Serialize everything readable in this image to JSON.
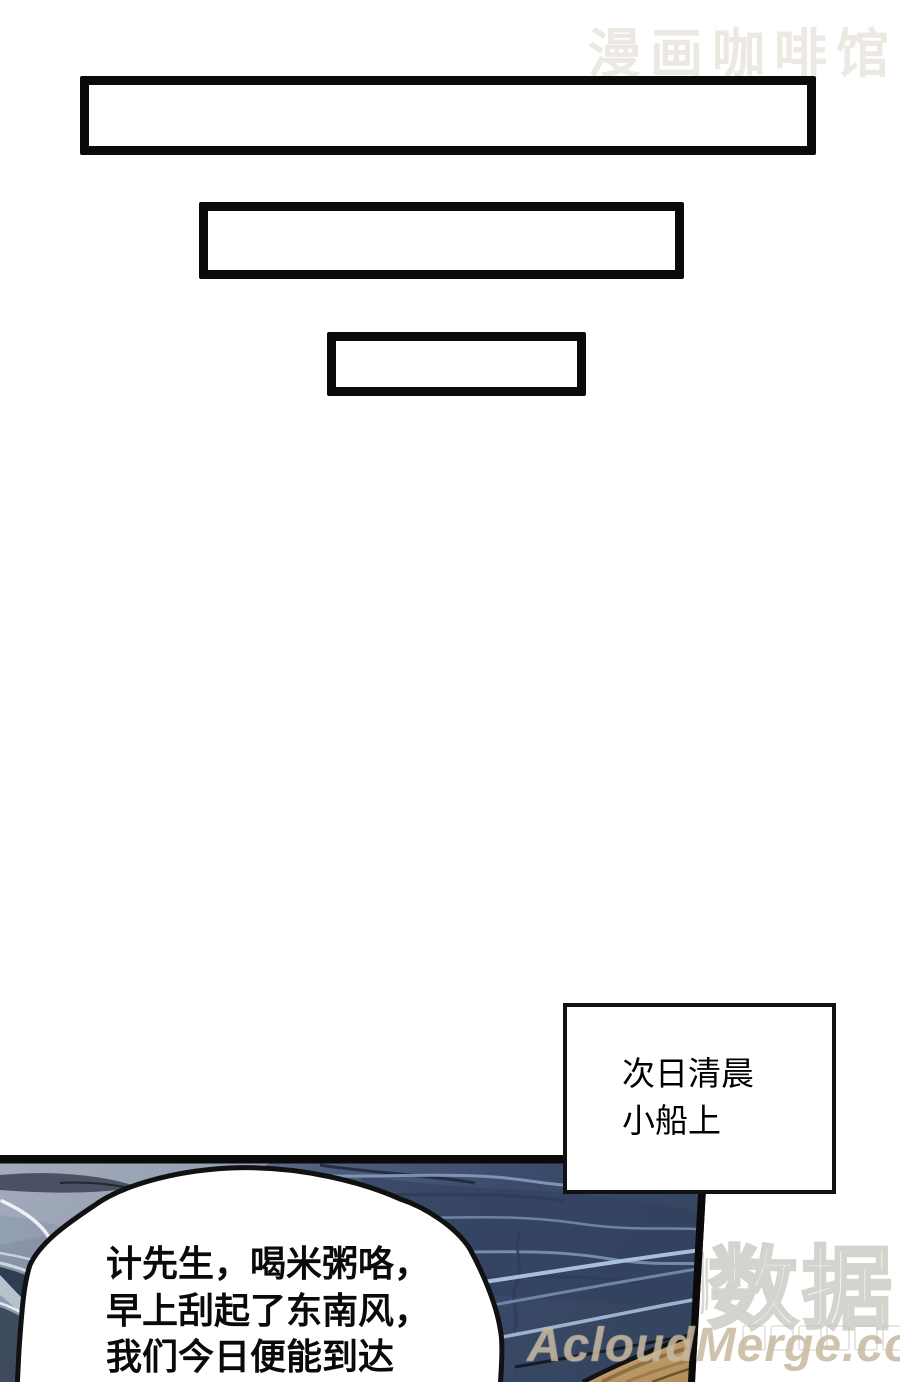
{
  "scene": {
    "top_watermark": {
      "text": "漫画咖啡馆",
      "color": "#ece9e3"
    },
    "caption_box": {
      "lines": [
        "次日清晨",
        "小船上"
      ]
    },
    "speech_bubble": {
      "lines": [
        "计先生，喝米粥咯，",
        "早上刮起了东南风，",
        "我们今日便能到达"
      ]
    },
    "bottom_watermark": {
      "big_text": "数据",
      "site_text": "AcloudMerge.com"
    },
    "palette": {
      "panel_outline": "#0a0a0a",
      "water_dark": "#36455f",
      "water_light": "#97a0b1",
      "wave_highlight": "#a9bed8",
      "wood": "#c2a06a",
      "watermark_outline": "#d5d3ce"
    }
  }
}
